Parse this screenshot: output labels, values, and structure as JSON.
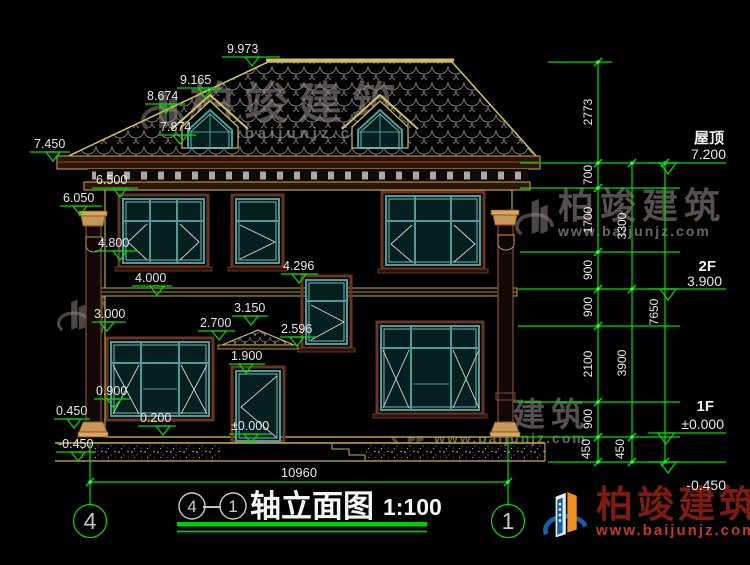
{
  "drawing": {
    "title": {
      "axis_left": "4",
      "separator": "—",
      "axis_right": "1",
      "name": "轴立面图",
      "scale": "1:100"
    }
  },
  "levels": [
    "9.973",
    "9.165",
    "8.674",
    "7.874",
    "7.450",
    "6.500",
    "6.050",
    "4.800",
    "4.296",
    "4.000",
    "3.150",
    "3.000",
    "2.700",
    "2.596",
    "1.900",
    "0.900",
    "0.450",
    "0.200",
    "±0.000",
    "-0.450"
  ],
  "floors": [
    {
      "label": "屋顶",
      "value": "7.200"
    },
    {
      "label": "2F",
      "value": "3.900"
    },
    {
      "label": "1F",
      "value": "±0.000"
    },
    {
      "label": "",
      "value": "-0.450"
    }
  ],
  "dims": {
    "total_width": "10960",
    "col1": [
      "2773",
      "700",
      "1700",
      "900",
      "900",
      "2100",
      "900",
      "450"
    ],
    "col2": [
      "3300",
      "3900",
      "450"
    ],
    "col3": [
      "7650"
    ]
  },
  "axes": {
    "left": "4",
    "right": "1"
  },
  "watermark": {
    "brand": "柏竣建筑",
    "url": "www.baijunjz.com"
  },
  "colors": {
    "accent_green": "#00dd00",
    "line_yellow": "#c8b050",
    "window_teal": "#4e9b9b",
    "trim_brown": "#6a3423",
    "dim_text": "#e8e8e8",
    "watermark_red": "#7e1b12",
    "logo_blue": "#1660a8",
    "logo_orange": "#ef8f1f"
  }
}
